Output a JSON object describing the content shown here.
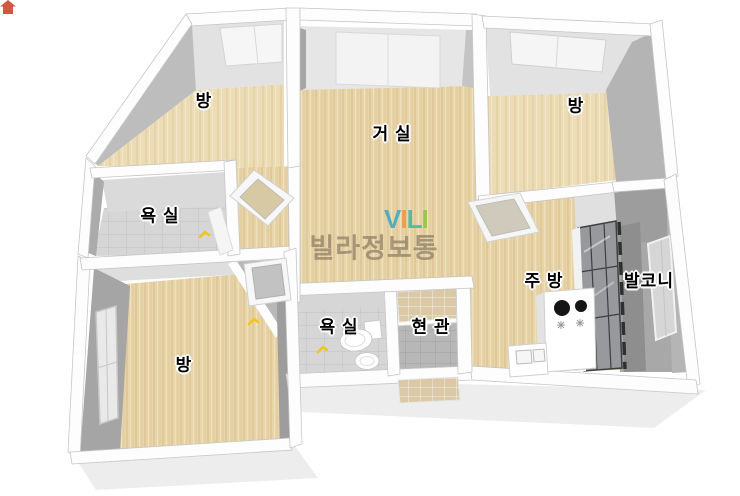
{
  "rooms": [
    {
      "id": "bedroom-top-left",
      "label": "방"
    },
    {
      "id": "living-room",
      "label": "거 실"
    },
    {
      "id": "bedroom-top-right",
      "label": "방"
    },
    {
      "id": "bathroom-upper",
      "label": "욕 실"
    },
    {
      "id": "bedroom-bottom-left",
      "label": "방"
    },
    {
      "id": "bathroom-lower",
      "label": "욕 실"
    },
    {
      "id": "entrance",
      "label": "현 관"
    },
    {
      "id": "kitchen",
      "label": "주 방"
    },
    {
      "id": "balcony",
      "label": "발코니"
    }
  ],
  "watermark": {
    "logo_letters": [
      "V",
      "I",
      "L",
      "I"
    ],
    "text": "빌라정보통"
  },
  "palette": {
    "wood_floor": "#e7d4a8",
    "wall_light": "#e2e2e2",
    "wall_dark": "#a5a5a5",
    "tile_gray": "#d6d6d6",
    "tile_entry": "#b7b7b7",
    "tile_tan": "#dac9a4",
    "balcony_gray": "#a8a8a8",
    "door_check_yellow": "#f0c51c",
    "logo_teal": "#3aa9c4",
    "logo_orange": "#f0933c",
    "logo_green": "#8cc63f",
    "logo_roof_red": "#c9462e",
    "watermark_gray": "#7c6d57"
  }
}
